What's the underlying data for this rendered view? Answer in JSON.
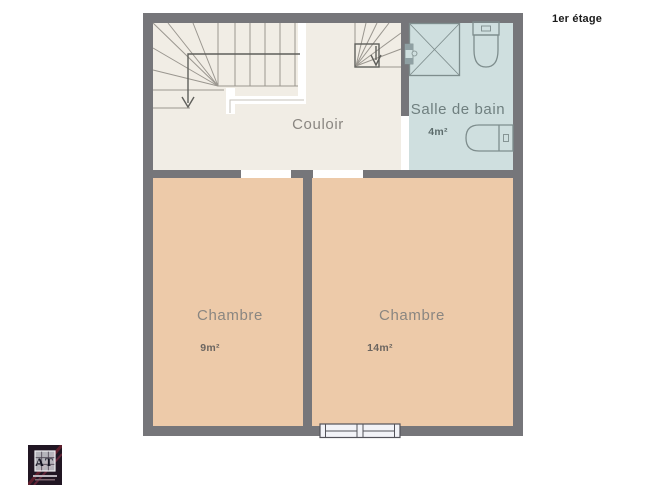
{
  "floor_title": "1er étage",
  "plan": {
    "rooms": {
      "couloir": {
        "label": "Couloir"
      },
      "salle_de_bain": {
        "label": "Salle de bain",
        "area": "4m²"
      },
      "chambre_1": {
        "label": "Chambre",
        "area": "9m²"
      },
      "chambre_2": {
        "label": "Chambre",
        "area": "14m²"
      }
    },
    "colors": {
      "wall": "#76767a",
      "couloir_floor": "#f1ede5",
      "bathroom_floor": "#cfdfdf",
      "bedroom_floor": "#edcaa9",
      "room_label": "#8a8681",
      "bathroom_label": "#6f7f7f",
      "area_label": "#6b6560",
      "title_text": "#1b1b1b"
    }
  },
  "logo": {
    "letters": "AT"
  }
}
